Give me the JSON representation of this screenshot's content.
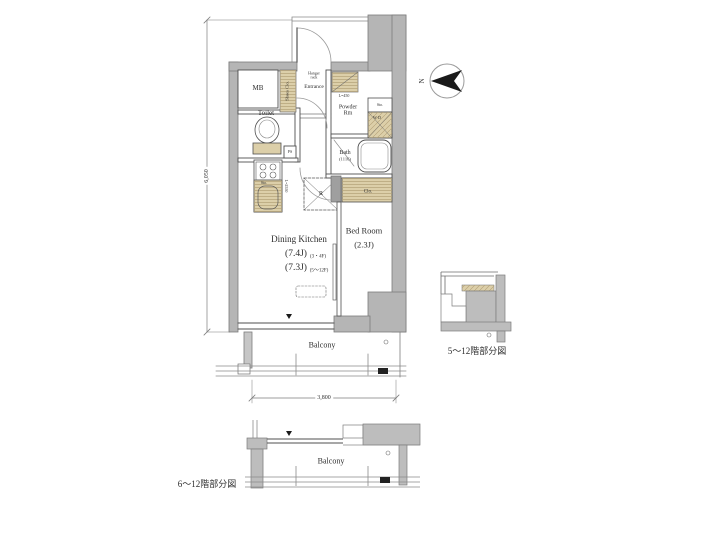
{
  "plan": {
    "rooms": {
      "mb": "MB",
      "shoes_closet": "Shoes Clo.",
      "entrance": "Entrance",
      "hanger_rack_line1": "Hanger",
      "hanger_rack_line2": "rack",
      "entrance_shelf_length": "L=450",
      "toilet": "Toilet",
      "ps": "PS",
      "powder_line1": "Powder",
      "powder_line2": "Rm",
      "powder_storage": "Sto.",
      "washer_dryer": "W·D",
      "bath": "Bath",
      "bath_module": "(1116)",
      "kitchen_storage": "Sto.",
      "kitchen_counter_length": "L=2550",
      "refrigerator": "R",
      "closet": "Clo.",
      "dining_kitchen": "Dining Kitchen",
      "dining_kitchen_size_3_4f": "(7.4J)",
      "dining_kitchen_size_3_4f_floors": "(3・4F)",
      "dining_kitchen_size_5_12f": "(7.3J)",
      "dining_kitchen_size_5_12f_floors": "(5〜12F)",
      "bedroom": "Bed Room",
      "bedroom_size": "(2.3J)",
      "balcony": "Balcony"
    },
    "dimensions": {
      "vertical": "6,050",
      "horizontal": "3,800"
    },
    "compass": {
      "north": "N"
    }
  },
  "partial_plans": {
    "right_caption": "5〜12階部分図",
    "bottom_caption": "6〜12階部分図",
    "bottom_balcony": "Balcony"
  },
  "colors": {
    "wall_gray": "#b5b5b5",
    "closet_tan": "#dccfa9",
    "line": "#4a4a4a",
    "background": "#ffffff"
  }
}
